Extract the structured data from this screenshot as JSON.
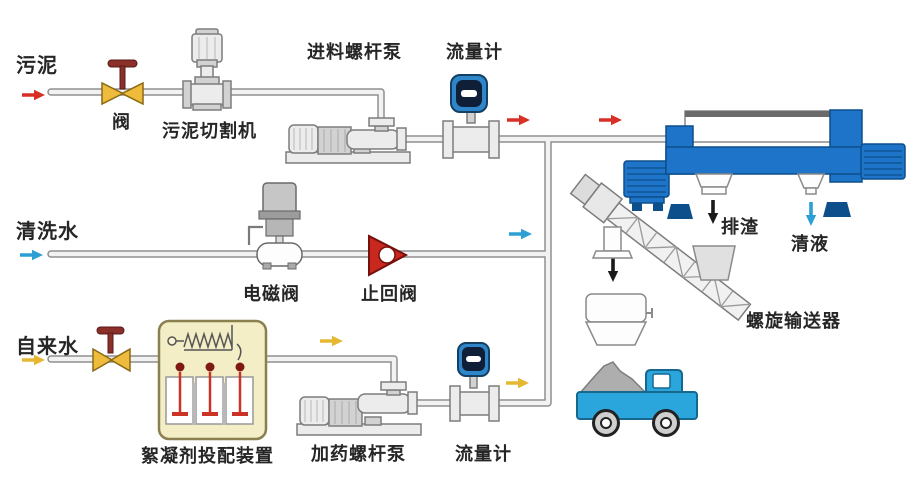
{
  "diagram": {
    "type": "sludge-dewatering-process-flow",
    "labels": {
      "sludge_inlet": "污泥",
      "valve": "阀",
      "sludge_cutter": "污泥切割机",
      "feed_screw_pump": "进料螺杆泵",
      "flow_meter_top": "流量计",
      "washing_water_inlet": "清洗水",
      "solenoid_valve": "电磁阀",
      "check_valve": "止回阀",
      "tap_water_inlet": "自来水",
      "flocculant_dosing_device": "絮凝剂投配装置",
      "dosing_screw_pump": "加药螺杆泵",
      "flow_meter_bottom": "流量计",
      "slag_discharge": "排渣",
      "clear_liquid": "清液",
      "screw_conveyor": "螺旋输送器"
    },
    "streams": [
      {
        "id": "sludge",
        "label": "污泥",
        "color_key": "sludge_flow",
        "direction": "right"
      },
      {
        "id": "washing_water",
        "label": "清洗水",
        "color_key": "water_flow",
        "direction": "right"
      },
      {
        "id": "tap_water",
        "label": "自来水",
        "color_key": "chemical_flow",
        "direction": "right"
      },
      {
        "id": "slag",
        "label": "排渣",
        "color_key": "solids_flow",
        "direction": "down"
      },
      {
        "id": "clear_liquid",
        "label": "清液",
        "color_key": "water_flow",
        "direction": "down"
      }
    ],
    "colors": {
      "sludge_flow": "#d93025",
      "water_flow": "#2e9fd4",
      "chemical_flow": "#e6b832",
      "solids_flow": "#1a1a1a",
      "centrifuge": "#1e74c8",
      "centrifuge_dark": "#0d4f8b",
      "valve_body": "#eebb3c",
      "valve_handle": "#8b2f2a",
      "check_valve": "#c8281e",
      "meter_blue": "#2e86c8",
      "meter_screen": "#101f38",
      "flocculant_box_fill": "#f3eec6",
      "flocculant_box_border": "#8a7f4e",
      "stirrer_red": "#cc3327",
      "truck_blue": "#2ba6dc",
      "pipe_edge": "#8f8f8f",
      "pipe_fill": "#f2f2f2",
      "equipment_fill": "#ececec",
      "equipment_edge": "#7d7d7d",
      "label_color": "#262626"
    }
  }
}
